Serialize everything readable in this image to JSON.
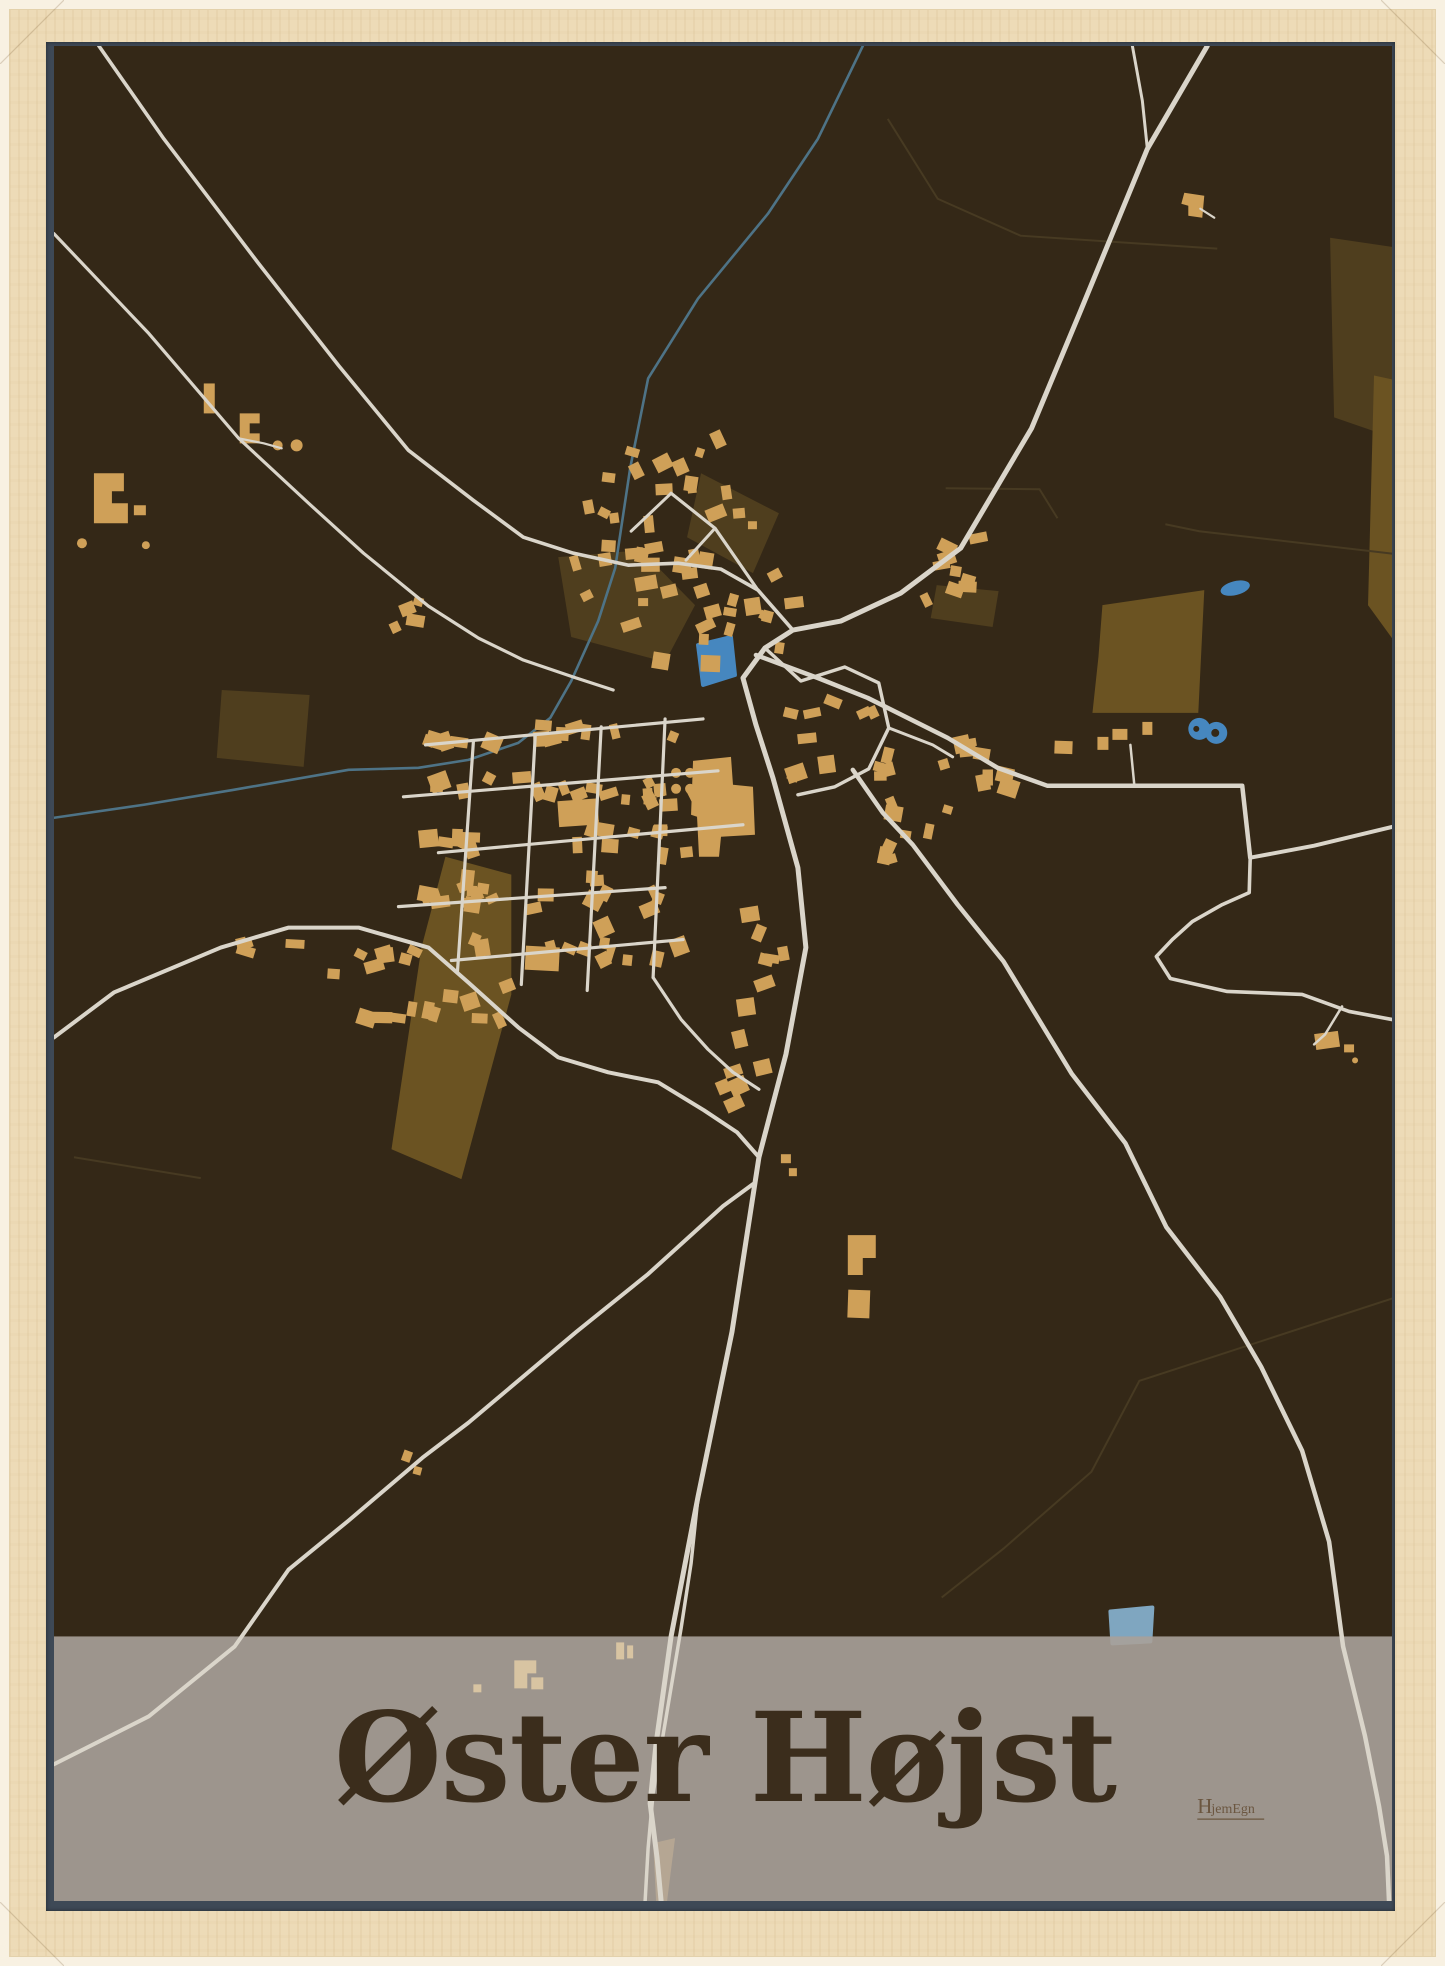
{
  "poster": {
    "title": "Øster Højst",
    "logo_h": "H",
    "logo_rest": "jemEgn"
  },
  "map": {
    "colors": {
      "background": "#342817",
      "field_light": "#6b5322",
      "field_dark": "#4f3e1e",
      "boundary": "#473a22",
      "river": "#4e7386",
      "pond": "#4687bf",
      "pond_muted": "#7fa6c0",
      "building": "#cfa058",
      "road": "#dad5ca",
      "band": "rgba(168,161,153,0.91)",
      "band_building": "#d8c4a2",
      "band_landuse": "#b5a693",
      "title_color": "#3b2d1c",
      "logo_color": "#6b5640"
    },
    "landuse": [
      {
        "t": "a",
        "pts": "1050,560 1152,545 1146,668 1040,668 1046,612"
      },
      {
        "t": "a",
        "pts": "392,812 458,830 458,950 408,1135 338,1105 368,903"
      },
      {
        "t": "b",
        "pts": "505,512 588,505 642,560 612,617 518,592"
      },
      {
        "t": "b",
        "pts": "648,428 726,468 700,528 634,492"
      },
      {
        "t": "b",
        "pts": "168,645 256,650 250,722 163,713"
      },
      {
        "t": "b",
        "pts": "1278,192 1345,202 1340,392 1282,372"
      },
      {
        "t": "a",
        "pts": "1322,330 1345,335 1345,600 1316,560"
      },
      {
        "t": "b",
        "pts": "884,540 946,546 940,582 878,573"
      }
    ],
    "boundaries": [
      "835,73 885,153 968,190 1165,203",
      "893,443 987,444 1005,473",
      "1113,479 1147,486 1345,509",
      "20,1113 147,1134",
      "1345,1253 1087,1337 1039,1428 951,1505 889,1554"
    ],
    "river": "810,0 765,93 715,168 645,253 595,333 577,423 562,523 545,576 518,636 497,673 465,698 415,715 365,723 295,725 180,745 90,760 0,773",
    "ponds": [
      {
        "type": "poly",
        "pts": "645,600 678,592 682,630 650,640"
      },
      {
        "type": "ellipse",
        "cx": 1183,
        "cy": 543,
        "rx": 15,
        "ry": 7,
        "rot": -14
      },
      {
        "type": "double",
        "c1": [
          1147,
          684
        ],
        "c2": [
          1164,
          688
        ],
        "r": 11,
        "holes": [
          [
            1144,
            684,
            3
          ],
          [
            1163,
            688,
            4
          ]
        ]
      },
      {
        "type": "poly",
        "muted": true,
        "pts": "1058,1568 1100,1564 1098,1598 1060,1600"
      }
    ],
    "roads": [
      {
        "w": 5.0,
        "d": "1155,0 1095,103 1027,268 979,383 908,503 848,548 788,576 740,585 712,603 690,633 703,680 720,733 745,823 753,903 733,1010 706,1113 679,1288 645,1453 618,1593 603,1700 597,1760 604,1815 608,1858"
      },
      {
        "w": 3.0,
        "d": "1080,0 1090,55 1095,103"
      },
      {
        "w": 3.6,
        "d": "45,0 110,93 205,218 285,320 355,405 420,455 470,492 520,508 575,520 625,518 668,524 705,545 740,585"
      },
      {
        "w": 3.2,
        "d": "0,188 95,288 185,393 255,458 310,508 375,561 425,593 470,615 520,632 560,645"
      },
      {
        "w": 4.0,
        "d": "0,993 60,948 167,903 235,883 305,883 375,903 415,938 465,983 505,1013 555,1028 605,1038 651,1066 684,1088 706,1113"
      },
      {
        "w": 4.0,
        "d": "700,1140 670,1162 595,1230 523,1288 415,1379 369,1414 295,1477 235,1526 181,1603 95,1673 0,1721"
      },
      {
        "w": 4.5,
        "d": "703,610 765,633 815,653 895,693 945,723 995,741 1190,741 1198,813"
      },
      {
        "w": 4.0,
        "d": "1198,813 1262,801 1345,781"
      },
      {
        "w": 3.6,
        "d": "1198,813 1197,848 1170,860 1140,877 1120,895 1104,912 1118,934 1175,947 1250,950 1297,967 1345,976"
      },
      {
        "w": 2.5,
        "d": "1290,962 1273,990 1262,1000"
      },
      {
        "w": 4.5,
        "d": "800,725 830,768 860,800 905,860 951,917 1019,1029 1073,1099 1114,1183 1168,1253 1209,1323 1250,1407 1277,1498 1291,1603 1313,1693 1327,1763 1335,1813 1337,1858"
      },
      {
        "w": 3.5,
        "d": "645,1453 638,1520 628,1585 612,1680 600,1750 595,1805 592,1858"
      },
      {
        "w": 3.2,
        "d": "372,700 650,674"
      },
      {
        "w": 3.2,
        "d": "350,752 665,726"
      },
      {
        "w": 3.2,
        "d": "385,808 690,780"
      },
      {
        "w": 3.2,
        "d": "345,862 612,843"
      },
      {
        "w": 3.2,
        "d": "398,916 630,895"
      },
      {
        "w": 3.2,
        "d": "420,697 404,928"
      },
      {
        "w": 3.2,
        "d": "482,690 468,940"
      },
      {
        "w": 3.2,
        "d": "548,682 534,946"
      },
      {
        "w": 3.2,
        "d": "612,674 600,933"
      },
      {
        "w": 3.2,
        "d": "600,933 628,975 655,1005 680,1028 706,1045"
      },
      {
        "w": 3.2,
        "d": "705,545 662,483 618,448"
      },
      {
        "w": 3.0,
        "d": "662,483 633,515"
      },
      {
        "w": 3.0,
        "d": "618,448 578,486"
      },
      {
        "w": 3.4,
        "d": "712,603 748,636 792,622 826,638 836,683 816,724 782,742 745,750"
      },
      {
        "w": 3.0,
        "d": "836,683 880,700 900,712"
      },
      {
        "w": 2.5,
        "d": "1082,741 1078,700"
      },
      {
        "w": 2.2,
        "d": "185,393 210,398 228,403"
      },
      {
        "w": 2.2,
        "d": "1162,172 1148,163"
      }
    ],
    "buildings": [
      {
        "poly": "640,716 678,712 680,740 700,742 702,790 668,792 666,812 646,812 644,772 638,770"
      },
      {
        "circle": [
          623,
          728,
          5
        ]
      },
      {
        "circle": [
          637,
          728,
          5
        ]
      },
      {
        "circle": [
          623,
          744,
          5
        ]
      },
      {
        "circle": [
          637,
          744,
          5
        ]
      },
      {
        "rect": [
          505,
          755,
          40,
          26,
          -4
        ]
      },
      {
        "rect": [
          472,
          902,
          34,
          24,
          3
        ]
      },
      {
        "poly": "795,1191 823,1191 823,1214 810,1214 810,1231 795,1231"
      },
      {
        "rect": [
          795,
          1246,
          22,
          28,
          2
        ]
      },
      {
        "poly": "1132,147 1152,150 1150,172 1136,170 1136,160 1129,158"
      },
      {
        "rect": [
          1263,
          988,
          24,
          16,
          -8
        ]
      },
      {
        "rect": [
          1292,
          1000,
          10,
          8,
          0
        ]
      },
      {
        "circle": [
          1303,
          1016,
          3
        ]
      },
      {
        "rect": [
          349,
          1407,
          9,
          11,
          20
        ]
      },
      {
        "rect": [
          360,
          1423,
          8,
          8,
          15
        ]
      },
      {
        "rect": [
          728,
          1110,
          10,
          9,
          0
        ]
      },
      {
        "rect": [
          736,
          1124,
          8,
          8,
          0
        ]
      },
      {
        "poly": "40,428 70,428 70,446 58,446 58,458 74,458 74,478 40,478"
      },
      {
        "rect": [
          80,
          460,
          12,
          10,
          0
        ]
      },
      {
        "circle": [
          28,
          498,
          5
        ]
      },
      {
        "circle": [
          92,
          500,
          4
        ]
      },
      {
        "rect": [
          150,
          338,
          11,
          30,
          0
        ]
      },
      {
        "poly": "186,368 206,368 206,378 196,378 196,388 206,388 206,398 186,398"
      },
      {
        "circle": [
          224,
          400,
          5
        ]
      },
      {
        "circle": [
          243,
          400,
          6
        ]
      },
      {
        "rect": [
          582,
          531,
          22,
          14,
          -10
        ]
      },
      {
        "rect": [
          608,
          540,
          16,
          12,
          -14
        ]
      },
      {
        "rect": [
          585,
          553,
          10,
          8,
          0
        ]
      },
      {
        "rect": [
          680,
          463,
          12,
          10,
          -5
        ]
      },
      {
        "rect": [
          695,
          476,
          9,
          8,
          0
        ]
      },
      {
        "rect": [
          1002,
          696,
          18,
          13,
          2
        ]
      },
      {
        "rect": [
          1045,
          692,
          11,
          13,
          0
        ]
      },
      {
        "rect": [
          1060,
          684,
          15,
          11,
          0
        ]
      },
      {
        "rect": [
          1090,
          677,
          10,
          13,
          0
        ]
      }
    ],
    "clusters": [
      [
        600,
        505,
        26,
        95,
        120,
        7
      ],
      [
        900,
        523,
        9,
        28,
        32,
        11
      ],
      [
        697,
        560,
        12,
        55,
        45,
        13
      ],
      [
        790,
        690,
        12,
        55,
        45,
        17
      ],
      [
        845,
        770,
        9,
        50,
        45,
        19
      ],
      [
        922,
        720,
        9,
        38,
        28,
        23
      ],
      [
        500,
        692,
        13,
        140,
        12,
        29
      ],
      [
        505,
        744,
        15,
        150,
        12,
        31
      ],
      [
        530,
        796,
        14,
        155,
        13,
        37
      ],
      [
        475,
        854,
        12,
        140,
        12,
        41
      ],
      [
        510,
        905,
        11,
        130,
        12,
        43
      ],
      [
        415,
        812,
        7,
        12,
        75,
        47
      ],
      [
        545,
        815,
        7,
        11,
        70,
        53
      ],
      [
        605,
        800,
        7,
        11,
        70,
        59
      ],
      [
        255,
        905,
        10,
        110,
        22,
        61
      ],
      [
        330,
        952,
        7,
        60,
        25,
        67
      ],
      [
        706,
        940,
        8,
        26,
        80,
        71
      ],
      [
        690,
        1060,
        5,
        20,
        45,
        73
      ],
      [
        628,
        515,
        6,
        45,
        14,
        79
      ],
      [
        340,
        560,
        4,
        40,
        25,
        83
      ],
      [
        430,
        958,
        5,
        35,
        18,
        89
      ]
    ],
    "band": {
      "y": 1593,
      "h": 265
    },
    "band_features": {
      "landuse": [
        "600,1800 622,1795 614,1858 603,1858"
      ],
      "buildings": [
        {
          "poly": "461,1617 483,1617 483,1630 474,1630 474,1645 461,1645"
        },
        {
          "rect": [
            478,
            1634,
            12,
            12,
            0
          ]
        },
        {
          "rect": [
            563,
            1599,
            8,
            17,
            0
          ]
        },
        {
          "rect": [
            574,
            1602,
            6,
            13,
            0
          ]
        },
        {
          "rect": [
            420,
            1641,
            8,
            8,
            0
          ]
        }
      ]
    },
    "title_pos": {
      "x": 672,
      "y": 1758,
      "size": 124
    },
    "logo_pos": {
      "x": 1145,
      "y": 1770
    }
  }
}
